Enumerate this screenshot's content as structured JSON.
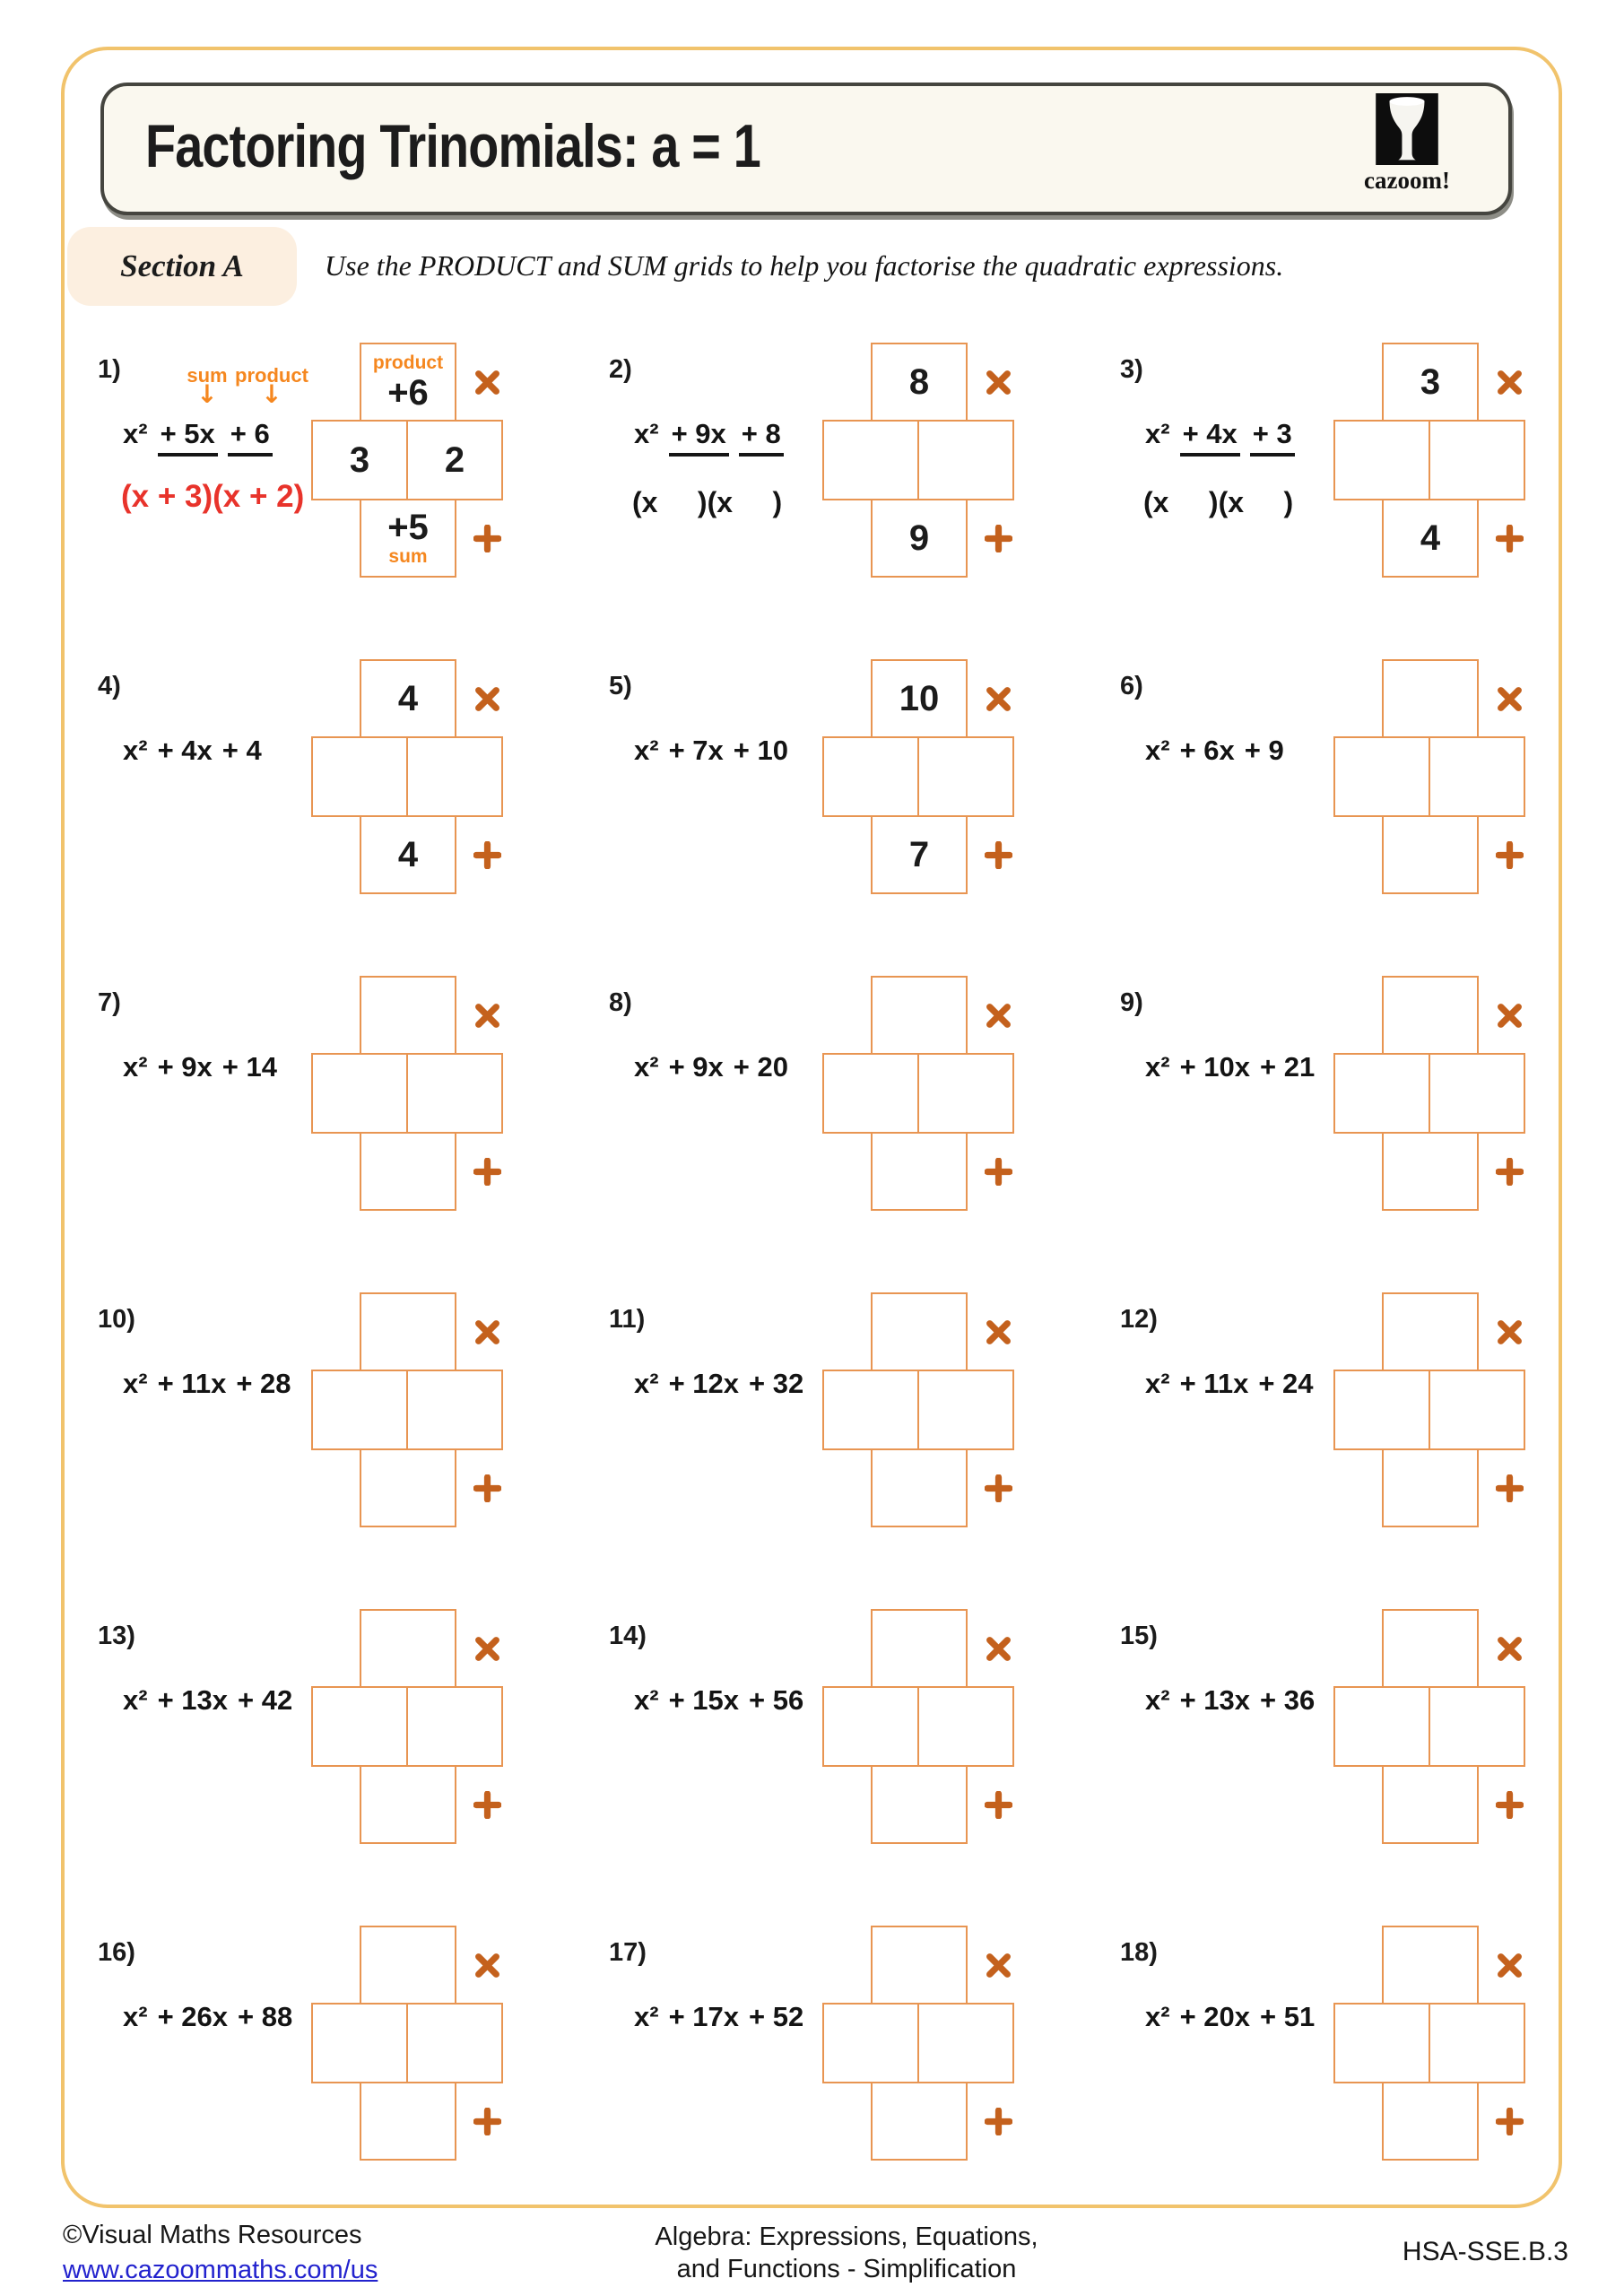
{
  "header": {
    "title": "Factoring Trinomials: a = 1",
    "brand": "cazoom!"
  },
  "section": {
    "label": "Section A",
    "instruction": "Use the PRODUCT and SUM grids to help you factorise the quadratic expressions."
  },
  "symbols": {
    "product_operator": "×",
    "sum_operator": "+",
    "arrow": "↓"
  },
  "colors": {
    "box_border": "#E89552",
    "operator_orange": "#C4611D",
    "label_orange": "#F5871F",
    "answer_red": "#E8332B",
    "page_border_gold": "#F1C36C",
    "link_blue": "#2222CE"
  },
  "problems": [
    {
      "number": "1)",
      "terms": [
        "x²",
        "+ 5x",
        "+ 6"
      ],
      "underlined": true,
      "annotations": {
        "sum": "sum",
        "product": "product"
      },
      "answer": "(x + 3)(x + 2)",
      "grid": {
        "product": "+6",
        "sum": "+5",
        "left": "3",
        "right": "2",
        "product_label": "product",
        "sum_label": "sum"
      }
    },
    {
      "number": "2)",
      "terms": [
        "x²",
        "+ 9x",
        "+ 8"
      ],
      "underlined": true,
      "parens": "(x     )(x     )",
      "grid": {
        "product": "8",
        "sum": "9",
        "left": "",
        "right": ""
      }
    },
    {
      "number": "3)",
      "terms": [
        "x²",
        "+ 4x",
        "+ 3"
      ],
      "underlined": true,
      "parens": "(x     )(x     )",
      "grid": {
        "product": "3",
        "sum": "4",
        "left": "",
        "right": ""
      }
    },
    {
      "number": "4)",
      "terms": [
        "x²",
        "+ 4x",
        "+ 4"
      ],
      "underlined": false,
      "grid": {
        "product": "4",
        "sum": "4",
        "left": "",
        "right": ""
      }
    },
    {
      "number": "5)",
      "terms": [
        "x²",
        "+ 7x",
        "+ 10"
      ],
      "underlined": false,
      "grid": {
        "product": "10",
        "sum": "7",
        "left": "",
        "right": ""
      }
    },
    {
      "number": "6)",
      "terms": [
        "x²",
        "+ 6x",
        "+ 9"
      ],
      "underlined": false,
      "grid": {
        "product": "",
        "sum": "",
        "left": "",
        "right": ""
      }
    },
    {
      "number": "7)",
      "terms": [
        "x²",
        "+ 9x",
        "+ 14"
      ],
      "underlined": false,
      "grid": {
        "product": "",
        "sum": "",
        "left": "",
        "right": ""
      }
    },
    {
      "number": "8)",
      "terms": [
        "x²",
        "+ 9x",
        "+ 20"
      ],
      "underlined": false,
      "grid": {
        "product": "",
        "sum": "",
        "left": "",
        "right": ""
      }
    },
    {
      "number": "9)",
      "terms": [
        "x²",
        "+ 10x",
        "+ 21"
      ],
      "underlined": false,
      "grid": {
        "product": "",
        "sum": "",
        "left": "",
        "right": ""
      }
    },
    {
      "number": "10)",
      "terms": [
        "x²",
        "+ 11x",
        "+ 28"
      ],
      "underlined": false,
      "grid": {
        "product": "",
        "sum": "",
        "left": "",
        "right": ""
      }
    },
    {
      "number": "11)",
      "terms": [
        "x²",
        "+ 12x",
        "+ 32"
      ],
      "underlined": false,
      "grid": {
        "product": "",
        "sum": "",
        "left": "",
        "right": ""
      }
    },
    {
      "number": "12)",
      "terms": [
        "x²",
        "+ 11x",
        "+ 24"
      ],
      "underlined": false,
      "grid": {
        "product": "",
        "sum": "",
        "left": "",
        "right": ""
      }
    },
    {
      "number": "13)",
      "terms": [
        "x²",
        "+ 13x",
        "+ 42"
      ],
      "underlined": false,
      "grid": {
        "product": "",
        "sum": "",
        "left": "",
        "right": ""
      }
    },
    {
      "number": "14)",
      "terms": [
        "x²",
        "+ 15x",
        "+ 56"
      ],
      "underlined": false,
      "grid": {
        "product": "",
        "sum": "",
        "left": "",
        "right": ""
      }
    },
    {
      "number": "15)",
      "terms": [
        "x²",
        "+ 13x",
        "+ 36"
      ],
      "underlined": false,
      "grid": {
        "product": "",
        "sum": "",
        "left": "",
        "right": ""
      }
    },
    {
      "number": "16)",
      "terms": [
        "x²",
        "+ 26x",
        "+ 88"
      ],
      "underlined": false,
      "grid": {
        "product": "",
        "sum": "",
        "left": "",
        "right": ""
      }
    },
    {
      "number": "17)",
      "terms": [
        "x²",
        "+ 17x",
        "+ 52"
      ],
      "underlined": false,
      "grid": {
        "product": "",
        "sum": "",
        "left": "",
        "right": ""
      }
    },
    {
      "number": "18)",
      "terms": [
        "x²",
        "+ 20x",
        "+ 51"
      ],
      "underlined": false,
      "grid": {
        "product": "",
        "sum": "",
        "left": "",
        "right": ""
      }
    }
  ],
  "footer": {
    "copyright": "©Visual Maths Resources",
    "link": "www.cazoommaths.com/us",
    "subject_line1": "Algebra: Expressions, Equations,",
    "subject_line2": "and Functions - Simplification",
    "standard_code": "HSA-SSE.B.3"
  }
}
